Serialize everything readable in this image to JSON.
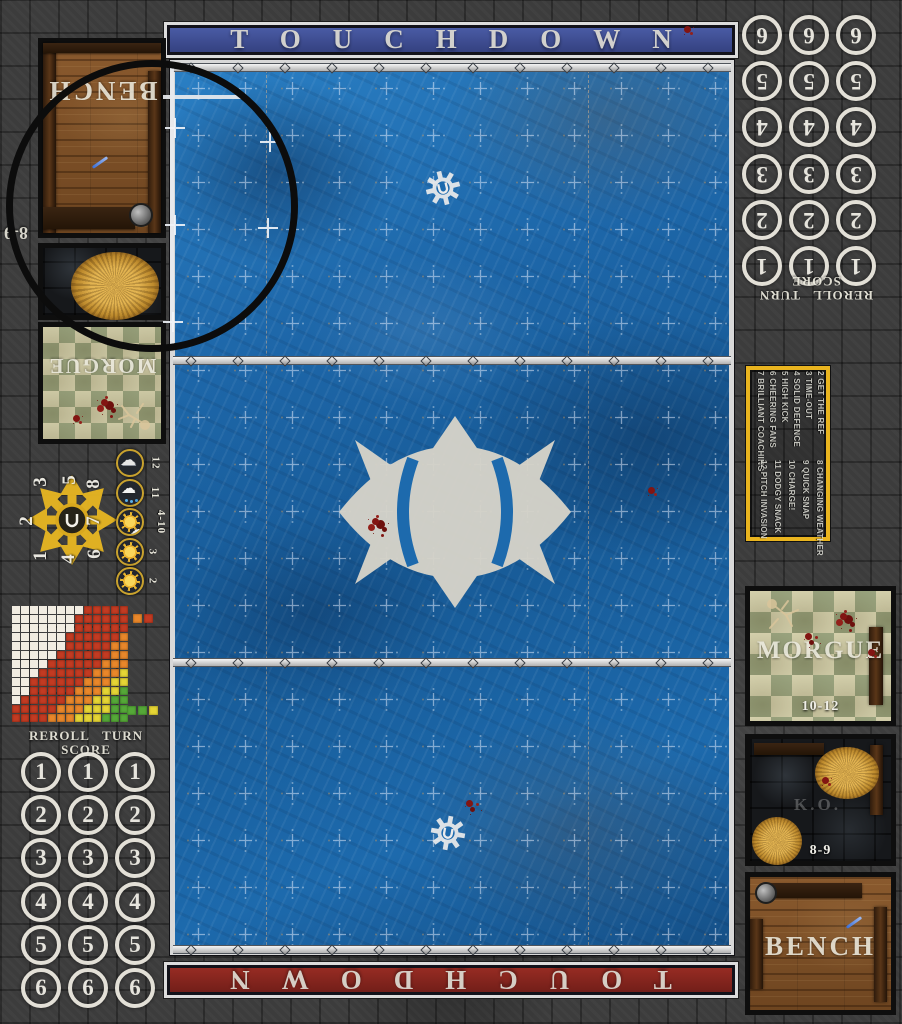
{
  "banners": {
    "top_label": "TOUCHDOWN",
    "bottom_label": "TOUCHDOWN"
  },
  "side_tracks": {
    "header": "REROLL TURN SCORE",
    "values": [
      "1",
      "2",
      "3",
      "4",
      "5",
      "6"
    ]
  },
  "dugouts": {
    "bench_label": "BENCH",
    "morgue_label": "MORGUE",
    "ko_label": "K.O.",
    "ko_range": "8-9",
    "morgue_range": "10-12"
  },
  "kickoff_table": {
    "rows_low": [
      "2 GET THE REF",
      "3 TIME-OUT",
      "4 SOLID DEFENCE",
      "5 HIGH KICK",
      "6 CHEERING FANS",
      "7 BRILLIANT COACHING"
    ],
    "rows_high": [
      "8 CHANGING WEATHER",
      "9 QUICK SNAP",
      "10 CHARGE!",
      "11 DODGY SNACK",
      "12 PITCH INVASION"
    ]
  },
  "weather_table": [
    {
      "roll": "12",
      "icon": "storm-cloud"
    },
    {
      "roll": "11",
      "icon": "rain-cloud"
    },
    {
      "roll": "4-10",
      "icon": "sun-behind-cloud"
    },
    {
      "roll": "3",
      "icon": "sun-small-cloud"
    },
    {
      "roll": "2",
      "icon": "sun"
    }
  ],
  "scatter_template": {
    "nw": "3",
    "n": "5",
    "ne": "8",
    "w": "2",
    "e": "7",
    "sw": "1",
    "s": "4",
    "se": "6"
  },
  "range_chart": {
    "rows": [
      "WWWWWWWWRRRRR",
      "WWWWWWWRRRRRR",
      "WWWWWWWRRRRRR",
      "WWWWWWRRRRRRO",
      "WWWWWWRRRRROO",
      "WWWWWRRRRRROO",
      "WWWWRRRRRROOO",
      "WWWRRRRRROOOY",
      "WWRRRRRROOOYY",
      "WWRRRRROOOYYG",
      "WRRRRROOOYYGG",
      "RRRRROOOYYYGG",
      "RRRROOOYYYGGG"
    ],
    "palette": {
      "W": "#f1ece1",
      "R": "#c23b22",
      "O": "#e8872a",
      "Y": "#e5d535",
      "G": "#55a838"
    },
    "legend_mid": [
      "O",
      "R"
    ],
    "legend_bottom": [
      "G",
      "G",
      "Y"
    ]
  },
  "colors": {
    "field_blue": "#1d6aad",
    "banner_top_blue": "#3e4f96",
    "banner_bottom_red": "#8e2a22",
    "kickoff_border_yellow": "#e9b41f",
    "stone_grey": "#3c3c3c",
    "blood_red": "#7f1410",
    "hay_gold": "#d8a53f",
    "star_yellow": "#e8b722"
  }
}
